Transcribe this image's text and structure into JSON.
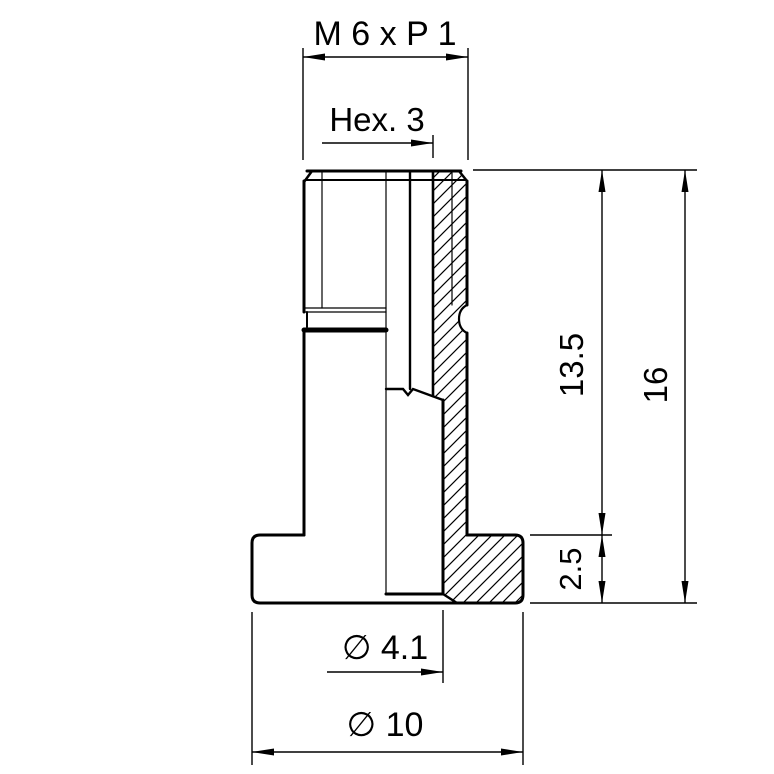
{
  "drawing": {
    "type": "engineering-drawing-half-section",
    "colors": {
      "background": "#ffffff",
      "line": "#000000"
    },
    "dimensions": {
      "thread_spec": "M 6 x P 1",
      "hex_socket": "Hex. 3",
      "shank_height": "13.5",
      "overall_height": "16",
      "flange_thickness": "2.5",
      "bore_diameter": "∅ 4.1",
      "flange_diameter": "∅ 10"
    }
  }
}
